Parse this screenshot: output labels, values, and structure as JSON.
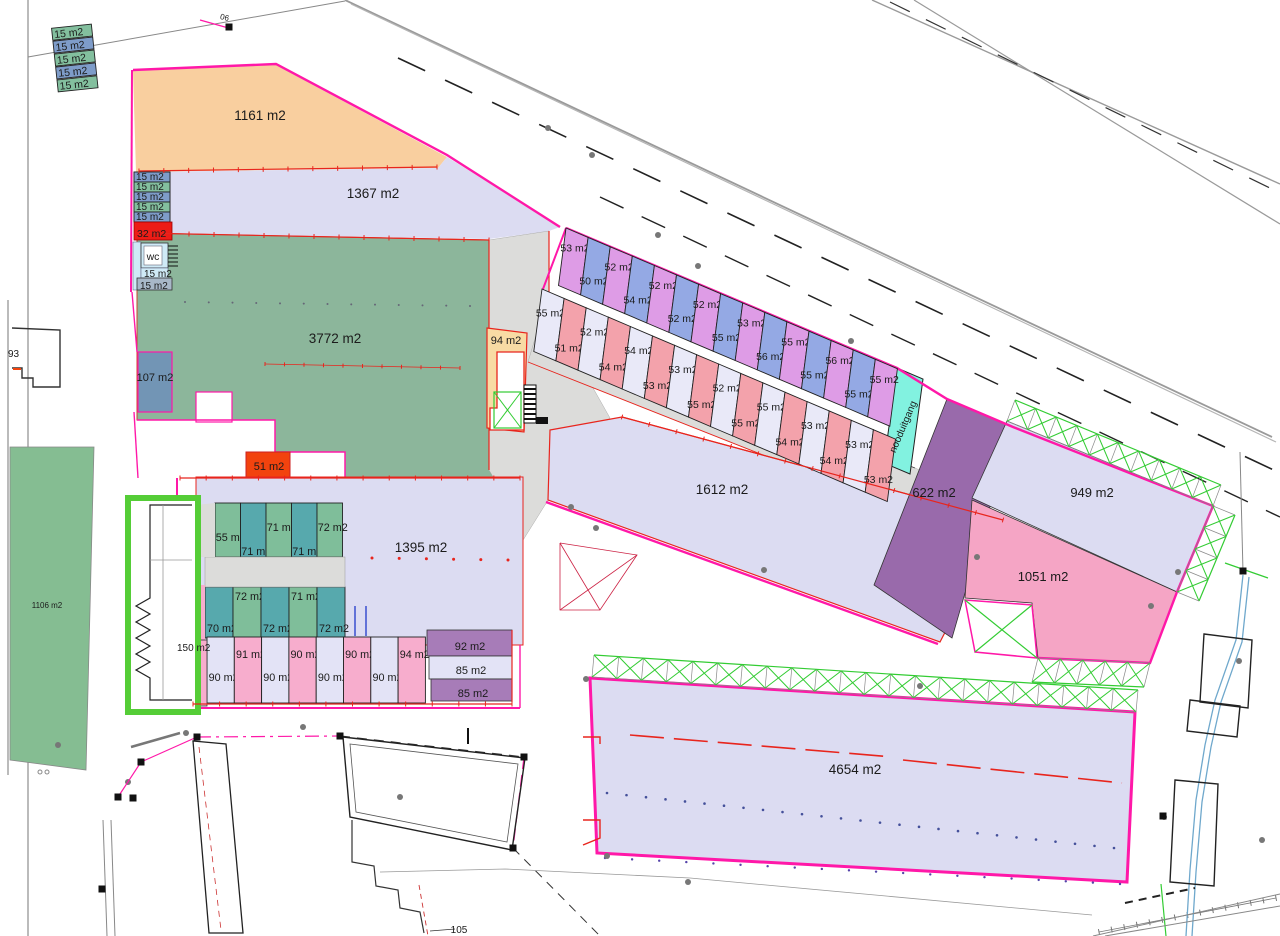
{
  "palette": {
    "magenta": "#ff18a8",
    "red": "#e8251d",
    "orange_red": "#f2430e",
    "red_cell": "#ed1c16",
    "road": "#9a9a9a",
    "lavender": "#dcdcf2",
    "orange": "#f9cf9f",
    "green_big": "#8cb69b",
    "green_parcel": "#85bd92",
    "steel_blue": "#7295b5",
    "yellow": "#f8dba4",
    "cyan_exit": "#82f2e0",
    "wc_cyan": "#cfeaf6",
    "cell_green": "#83bf9e",
    "cell_blue": "#7e9cc9",
    "strip_violet": "#de9ce6",
    "strip_blue": "#94a9e4",
    "strip_pale": "#e9e9f8",
    "strip_pink": "#f3a2ab",
    "grid_teal": "#57a9ad",
    "grid_green": "#7fbe9a",
    "row_pale": "#e3e3f6",
    "row_pink": "#f7adcd",
    "purple": "#996aab",
    "purple_light": "#a77cb8",
    "pink_big": "#f5a5c5",
    "bright_green": "#55cd37",
    "truss_green": "#33cc33",
    "gray_fill": "#dcdcda",
    "blue_line": "#6fa8cc"
  },
  "areas": {
    "a1161": "1161 m2",
    "a1367": "1367 m2",
    "a3772": "3772 m2",
    "a107": "107 m2",
    "a94": "94 m2",
    "a51": "51 m2",
    "a32": "32 m2",
    "wc": "wc",
    "wc15a": "15 m2",
    "wc15b": "15 m2",
    "a1612": "1612 m2",
    "a622": "622 m2",
    "a949": "949 m2",
    "a1051": "1051 m2",
    "a1395": "1395 m2",
    "a4654": "4654 m2",
    "a1106": "1106 m2",
    "a150": "150 m2",
    "a92": "92 m2",
    "a85a": "85 m2",
    "a85b": "85 m2",
    "nooduitgang": "nooduitgang",
    "p93": "93",
    "p105": "105",
    "p06": "06"
  },
  "top_left_cells": [
    {
      "label": "15 m2",
      "color": "cell_green"
    },
    {
      "label": "15 m2",
      "color": "cell_blue"
    },
    {
      "label": "15 m2",
      "color": "cell_green"
    },
    {
      "label": "15 m2",
      "color": "cell_blue"
    },
    {
      "label": "15 m2",
      "color": "cell_green"
    }
  ],
  "left_cells": [
    {
      "label": "15 m2",
      "color": "cell_blue"
    },
    {
      "label": "15 m2",
      "color": "cell_green"
    },
    {
      "label": "15 m2",
      "color": "cell_blue"
    },
    {
      "label": "15 m2",
      "color": "cell_green"
    },
    {
      "label": "15 m2",
      "color": "cell_blue"
    }
  ],
  "strip_row1": [
    {
      "label": "53 m2",
      "color": "strip_violet"
    },
    {
      "label": "50 m2",
      "color": "strip_blue"
    },
    {
      "label": "52 m2",
      "color": "strip_violet"
    },
    {
      "label": "54 m2",
      "color": "strip_blue"
    },
    {
      "label": "52 m2",
      "color": "strip_violet"
    },
    {
      "label": "52 m2",
      "color": "strip_blue"
    },
    {
      "label": "52 m2",
      "color": "strip_violet"
    },
    {
      "label": "55 m2",
      "color": "strip_blue"
    },
    {
      "label": "53 m2",
      "color": "strip_violet"
    },
    {
      "label": "56 m2",
      "color": "strip_blue"
    },
    {
      "label": "55 m2",
      "color": "strip_violet"
    },
    {
      "label": "55 m2",
      "color": "strip_blue"
    },
    {
      "label": "56 m2",
      "color": "strip_violet"
    },
    {
      "label": "55 m2",
      "color": "strip_blue"
    },
    {
      "label": "55 m2",
      "color": "strip_violet"
    }
  ],
  "strip_row2": [
    {
      "label": "55 m2",
      "color": "strip_pale"
    },
    {
      "label": "51 m2",
      "color": "strip_pink"
    },
    {
      "label": "52 m2",
      "color": "strip_pale"
    },
    {
      "label": "54 m2",
      "color": "strip_pink"
    },
    {
      "label": "54 m2",
      "color": "strip_pale"
    },
    {
      "label": "53 m2",
      "color": "strip_pink"
    },
    {
      "label": "53 m2",
      "color": "strip_pale"
    },
    {
      "label": "55 m2",
      "color": "strip_pink"
    },
    {
      "label": "52 m2",
      "color": "strip_pale"
    },
    {
      "label": "55 m2",
      "color": "strip_pink"
    },
    {
      "label": "55 m2",
      "color": "strip_pale"
    },
    {
      "label": "54 m2",
      "color": "strip_pink"
    },
    {
      "label": "53 m2",
      "color": "strip_pale"
    },
    {
      "label": "54 m2",
      "color": "strip_pink"
    },
    {
      "label": "53 m2",
      "color": "strip_pale"
    },
    {
      "label": "53 m2",
      "color": "strip_pink"
    }
  ],
  "grid_upper": [
    {
      "label": "55 m2",
      "color": "grid_green",
      "pos": "mid"
    },
    {
      "label": "71 m2",
      "color": "grid_teal",
      "pos": "low"
    },
    {
      "label": "71 m2",
      "color": "grid_green",
      "pos": "hi"
    },
    {
      "label": "71 m2",
      "color": "grid_teal",
      "pos": "low"
    },
    {
      "label": "72 m2",
      "color": "grid_green",
      "pos": "hi"
    }
  ],
  "grid_lower": [
    {
      "label": "70 m2",
      "color": "grid_teal",
      "pos": "low"
    },
    {
      "label": "72 m2",
      "color": "grid_green",
      "pos": "hi"
    },
    {
      "label": "72 m2",
      "color": "grid_teal",
      "pos": "low"
    },
    {
      "label": "71 m2",
      "color": "grid_green",
      "pos": "hi"
    },
    {
      "label": "72 m2",
      "color": "grid_teal",
      "pos": "low"
    }
  ],
  "pink_row": [
    {
      "label": "90 m2",
      "color": "row_pale",
      "pos": "low"
    },
    {
      "label": "91 m2",
      "color": "row_pink",
      "pos": "hi"
    },
    {
      "label": "90 m2",
      "color": "row_pale",
      "pos": "low"
    },
    {
      "label": "90 m2",
      "color": "row_pink",
      "pos": "hi"
    },
    {
      "label": "90 m2",
      "color": "row_pale",
      "pos": "low"
    },
    {
      "label": "90 m2",
      "color": "row_pink",
      "pos": "hi"
    },
    {
      "label": "90 m2",
      "color": "row_pale",
      "pos": "low"
    },
    {
      "label": "94 m2",
      "color": "row_pink",
      "pos": "hi"
    }
  ]
}
